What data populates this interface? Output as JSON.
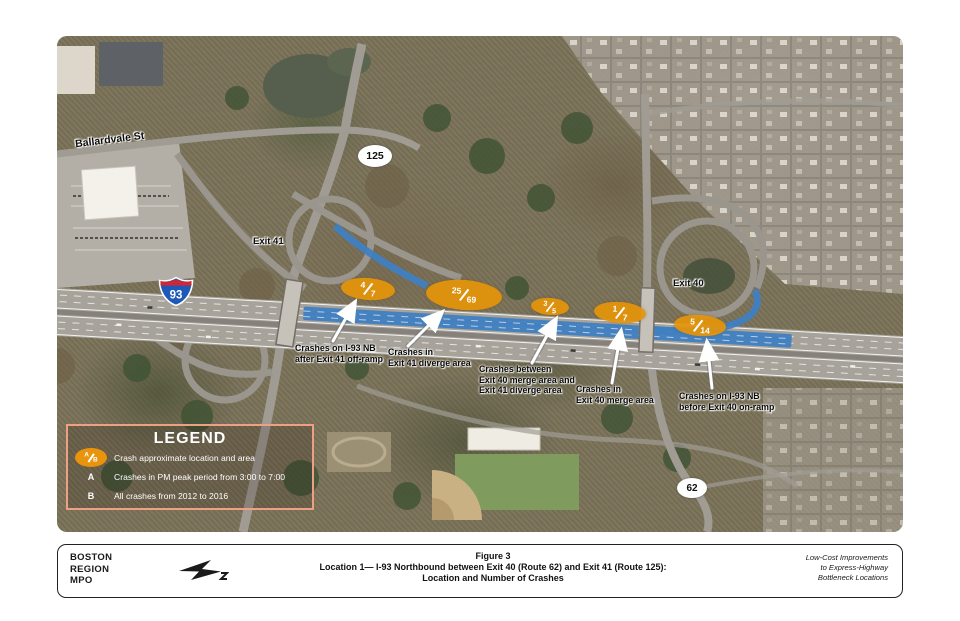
{
  "map": {
    "street_label": "Ballardvale St",
    "route_markers": {
      "i93": "93",
      "r125": "125",
      "r62": "62"
    },
    "exit_labels": {
      "exit41": "Exit 41",
      "exit40": "Exit 40"
    },
    "crash_ellipses": [
      {
        "pm": "4",
        "total": "7",
        "location": "I-93 NB after Exit 41 off-ramp"
      },
      {
        "pm": "25",
        "total": "69",
        "location": "Exit 41 diverge area"
      },
      {
        "pm": "3",
        "total": "5",
        "location": "between Exit 40 merge area and Exit 41 diverge area"
      },
      {
        "pm": "1",
        "total": "7",
        "location": "Exit 40 merge area"
      },
      {
        "pm": "5",
        "total": "14",
        "location": "I-93 NB before Exit 40 on-ramp"
      }
    ],
    "callouts": [
      {
        "lines": [
          "Crashes on I-93 NB",
          "after Exit 41 off-ramp"
        ]
      },
      {
        "lines": [
          "Crashes in",
          "Exit 41 diverge area"
        ]
      },
      {
        "lines": [
          "Crashes between",
          "Exit 40 merge area and",
          "Exit 41 diverge area"
        ]
      },
      {
        "lines": [
          "Crashes in",
          "Exit 40 merge area"
        ]
      },
      {
        "lines": [
          "Crashes on I-93 NB",
          "before Exit 40 on-ramp"
        ]
      }
    ],
    "colors": {
      "crash_orange": "#E8940C",
      "highlight_blue": "#3F7FC1",
      "legend_border": "#EDA083"
    }
  },
  "legend": {
    "title": "LEGEND",
    "symbol": {
      "a": "A",
      "b": "B"
    },
    "items": [
      {
        "key": "A/B",
        "label": "Crash approximate location and area"
      },
      {
        "key": "A",
        "label": "Crashes in PM peak period from 3:00 to 7:00"
      },
      {
        "key": "B",
        "label": "All crashes from 2012 to 2016"
      }
    ]
  },
  "footer": {
    "org_lines": [
      "BOSTON",
      "REGION",
      "MPO"
    ],
    "title_lines": [
      "Figure 3",
      "Location 1— I-93 Northbound between Exit 40 (Route 62) and Exit 41 (Route 125):",
      "Location and Number of Crashes"
    ],
    "project_lines": [
      "Low-Cost Improvements",
      "to Express-Highway",
      "Bottleneck Locations"
    ]
  }
}
